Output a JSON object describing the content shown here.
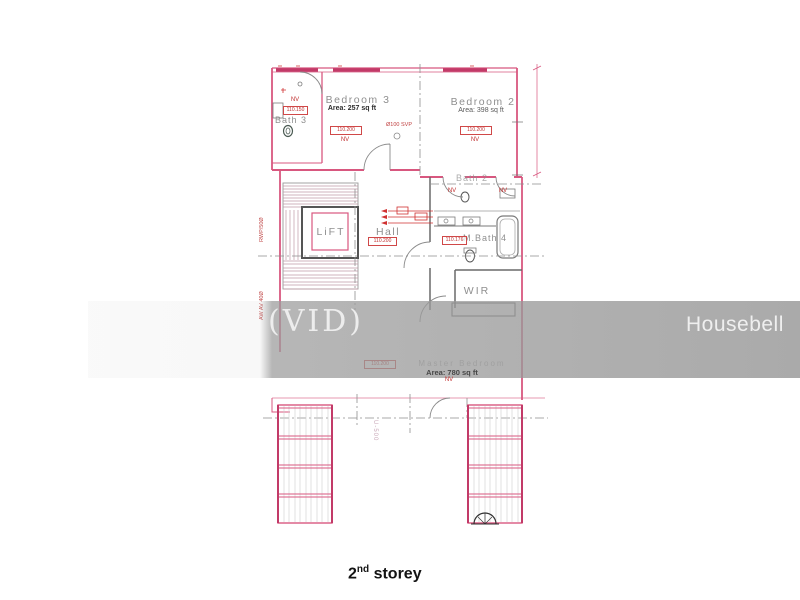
{
  "watermark": {
    "vid_text": "(VID)",
    "brand_text": "Housebell"
  },
  "caption": {
    "number": "2",
    "ordinal": "nd",
    "word": "storey"
  },
  "rooms": {
    "bedroom3": {
      "label": "Bedroom 3",
      "area": "Area: 257 sq ft"
    },
    "bedroom2": {
      "label": "Bedroom 2",
      "area": "Area: 398 sq ft"
    },
    "bath3": {
      "label": "Bath 3"
    },
    "bath2": {
      "label": "Bath 2"
    },
    "lift": {
      "label": "LiFT"
    },
    "hall": {
      "label": "Hall"
    },
    "mbath4": {
      "label": "M.Bath 4"
    },
    "wir": {
      "label": "WIR"
    },
    "master": {
      "label": "Master Bedroom",
      "area": "Area: 780 sq ft"
    }
  },
  "tags": {
    "bedroom3": "110.200",
    "bedroom2": "110.200",
    "bath3": "110.150",
    "hall": "110.200",
    "mbath4": "110.176",
    "master": "110.200",
    "nv": "NV"
  },
  "annotations": {
    "svp": "Ø100 SVP",
    "rwp": "RWP/50Ø",
    "aw": "AW AV 40Ø",
    "u500": "U-500"
  },
  "colors": {
    "wall_pink": "#d8577f",
    "window_pink": "#c23a68",
    "annotation_red": "#c03030",
    "line_gray": "#6a6a6a",
    "watermark_gray": "#c9c9c9"
  }
}
